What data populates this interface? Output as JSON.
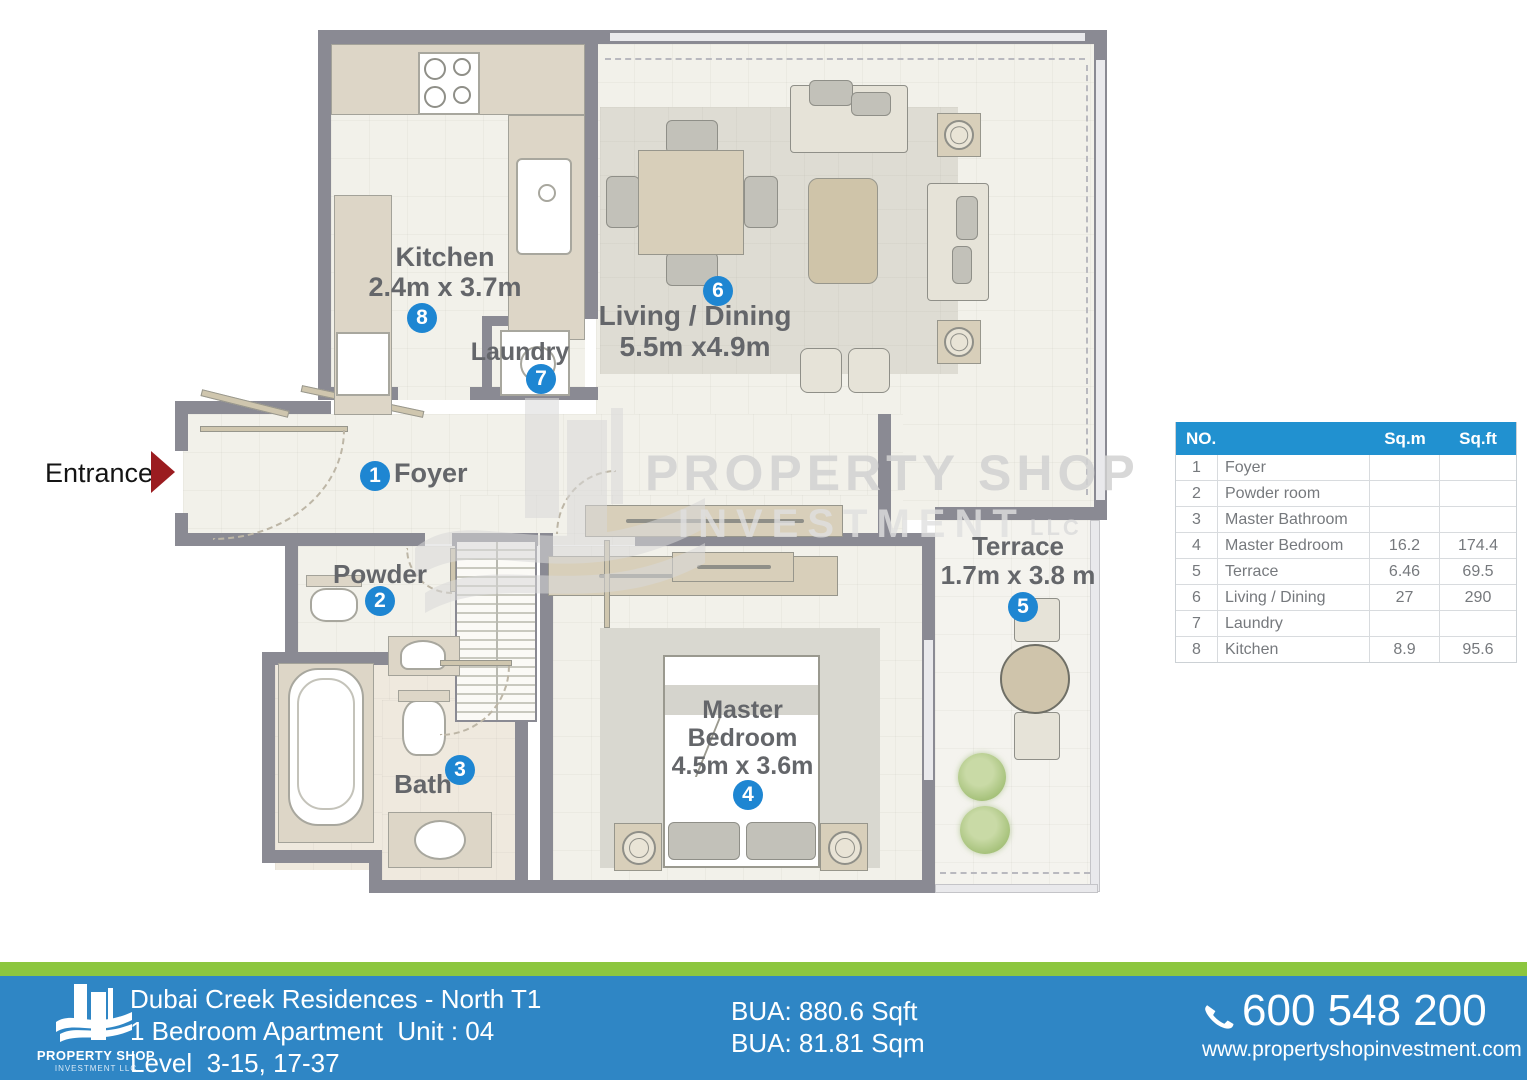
{
  "entrance": {
    "label": "Entrance"
  },
  "rooms": {
    "foyer": {
      "num": "1",
      "label": "Foyer"
    },
    "powder": {
      "num": "2",
      "label": "Powder"
    },
    "bath": {
      "num": "3",
      "label": "Bath"
    },
    "master": {
      "num": "4",
      "line1": "Master",
      "line2": "Bedroom",
      "dims": "4.5m x 3.6m"
    },
    "terrace": {
      "num": "5",
      "label": "Terrace",
      "dims": "1.7m x 3.8 m"
    },
    "living": {
      "num": "6",
      "label": "Living / Dining",
      "dims": "5.5m x4.9m"
    },
    "laundry": {
      "num": "7",
      "label": "Laundry"
    },
    "kitchen": {
      "num": "8",
      "label": "Kitchen",
      "dims": "2.4m x 3.7m"
    }
  },
  "watermark": {
    "brand": "PROPERTY SHOP",
    "brand2": "INVESTMENT",
    "suffix": "LLC"
  },
  "area_table": {
    "headers": {
      "no": "NO.",
      "sqm": "Sq.m",
      "sqft": "Sq.ft"
    },
    "rows": [
      {
        "no": "1",
        "name": "Foyer",
        "sqm": "",
        "sqft": ""
      },
      {
        "no": "2",
        "name": "Powder room",
        "sqm": "",
        "sqft": ""
      },
      {
        "no": "3",
        "name": "Master Bathroom",
        "sqm": "",
        "sqft": ""
      },
      {
        "no": "4",
        "name": "Master Bedroom",
        "sqm": "16.2",
        "sqft": "174.4"
      },
      {
        "no": "5",
        "name": "Terrace",
        "sqm": "6.46",
        "sqft": "69.5"
      },
      {
        "no": "6",
        "name": "Living / Dining",
        "sqm": "27",
        "sqft": "290"
      },
      {
        "no": "7",
        "name": "Laundry",
        "sqm": "",
        "sqft": ""
      },
      {
        "no": "8",
        "name": "Kitchen",
        "sqm": "8.9",
        "sqft": "95.6"
      }
    ]
  },
  "footer": {
    "logo": {
      "line1": "PROPERTY SHOP",
      "line2": "INVESTMENT LLC"
    },
    "project": "Dubai Creek Residences - North T1",
    "unit": "1 Bedroom Apartment  Unit : 04",
    "level": "Level  3-15, 17-37",
    "bua_sqft": "BUA: 880.6 Sqft",
    "bua_sqm": "BUA: 81.81 Sqm",
    "phone": "600 548 200",
    "website": "www.propertyshopinvestment.com"
  },
  "colors": {
    "badge_blue": "#1e86d2",
    "table_header_blue": "#2191d0",
    "footer_blue": "#2f86c5",
    "footer_green": "#8cc63f",
    "entrance_arrow_red": "#9b1c20",
    "wall_gray": "#8a8a93"
  }
}
